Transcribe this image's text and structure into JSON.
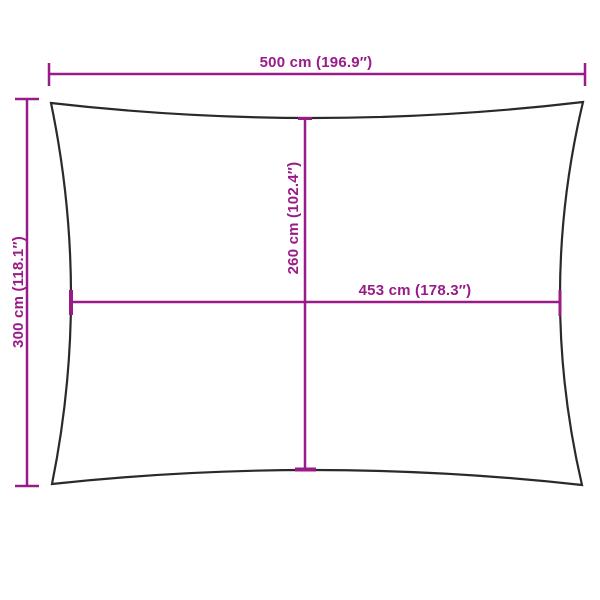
{
  "colors": {
    "dimension": "#991b87",
    "outline": "#2a2a2a",
    "background": "#ffffff"
  },
  "diagram": {
    "labels": {
      "overall_width": "500 cm (196.9″)",
      "overall_height": "300 cm (118.1″)",
      "inner_height": "260 cm (102.4″)",
      "inner_width": "453 cm (178.3″)"
    },
    "dimensions": {
      "overall_width": {
        "cm": 500,
        "inches": 196.9
      },
      "overall_height": {
        "cm": 300,
        "inches": 118.1
      },
      "inner_height": {
        "cm": 260,
        "inches": 102.4
      },
      "inner_width": {
        "cm": 453,
        "inches": 178.3
      }
    }
  }
}
